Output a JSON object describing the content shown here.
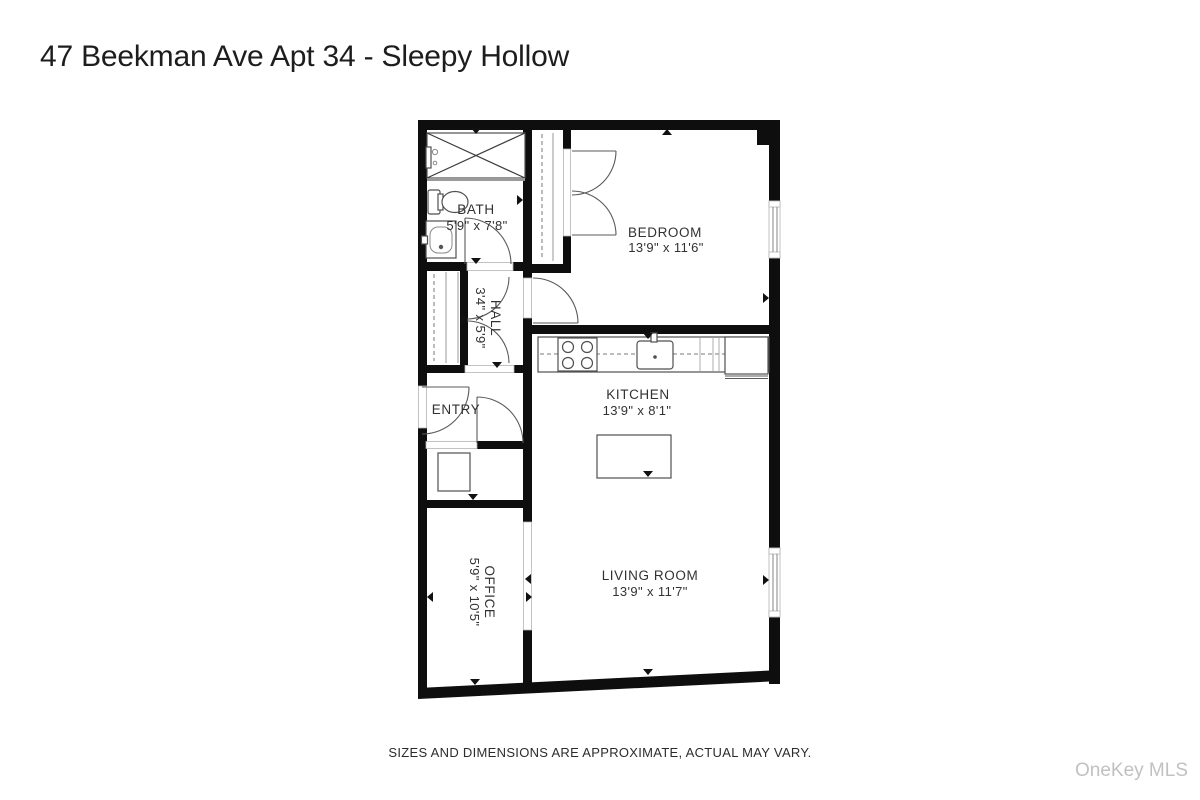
{
  "title": "47 Beekman Ave Apt 34 - Sleepy Hollow",
  "disclaimer": "SIZES AND DIMENSIONS ARE APPROXIMATE, ACTUAL MAY VARY.",
  "watermark": "OneKey MLS",
  "rooms": {
    "bath": {
      "name": "BATH",
      "dims": "5'9\" x 7'8\""
    },
    "bedroom": {
      "name": "BEDROOM",
      "dims": "13'9\" x 11'6\""
    },
    "hall": {
      "name": "HALL",
      "dims": "3'4\" x 5'9\""
    },
    "entry": {
      "name": "ENTRY",
      "dims": ""
    },
    "kitchen": {
      "name": "KITCHEN",
      "dims": "13'9\" x 8'1\""
    },
    "office": {
      "name": "OFFICE",
      "dims": "5'9\" x 10'5\""
    },
    "living": {
      "name": "LIVING ROOM",
      "dims": "13'9\" x 11'7\""
    }
  },
  "colors": {
    "wall": "#0e0e0e",
    "fixture_line": "#4f4f4f",
    "label_text": "#323232",
    "watermark": "#c1c1c1",
    "background": "#ffffff"
  }
}
